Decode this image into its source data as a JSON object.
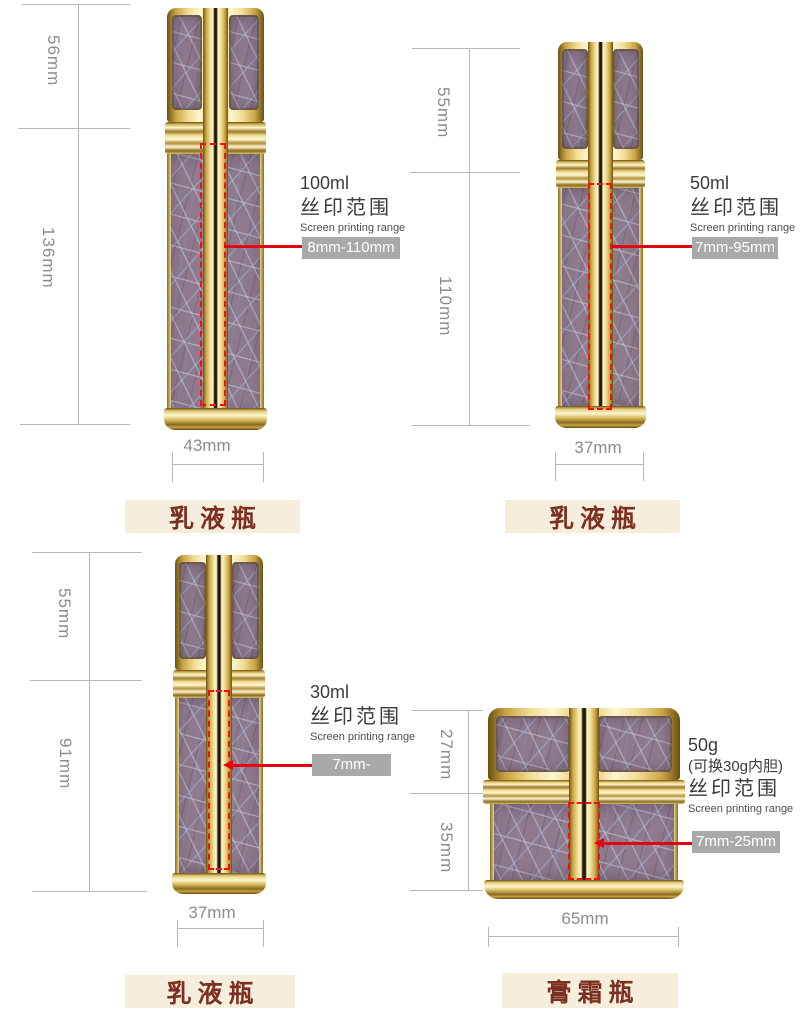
{
  "colors": {
    "accent_red": "#e60012",
    "badge_bg": "#a9a9a9",
    "badge_text": "#ffffff",
    "category_bg": "#f5eedd",
    "category_text": "#7c2f22",
    "dim_line": "#b7b7b7",
    "dim_text": "#8c8c8c",
    "gold_light": "#fdf6cf",
    "gold_mid": "#d4b254",
    "gold_dark": "#8a6a20",
    "texture_base": "#8d7a8c"
  },
  "products": [
    {
      "id": "lotion-bottle-100ml",
      "volume": "100ml",
      "print_range_cn": "丝印范围",
      "print_range_en": "Screen printing range",
      "print_range_value": "8mm-110mm",
      "dims": {
        "cap": "56mm",
        "body": "136mm",
        "width": "43mm"
      },
      "category": "乳液瓶"
    },
    {
      "id": "lotion-bottle-50ml",
      "volume": "50ml",
      "print_range_cn": "丝印范围",
      "print_range_en": "Screen printing range",
      "print_range_value": "7mm-95mm",
      "dims": {
        "cap": "55mm",
        "body": "110mm",
        "width": "37mm"
      },
      "category": "乳液瓶"
    },
    {
      "id": "lotion-bottle-30ml",
      "volume": "30ml",
      "print_range_cn": "丝印范围",
      "print_range_en": "Screen printing range",
      "print_range_value": "7mm-70mm",
      "dims": {
        "cap": "55mm",
        "body": "91mm",
        "width": "37mm"
      },
      "category": "乳液瓶"
    },
    {
      "id": "cream-jar-50g",
      "volume": "50g",
      "volume_note": "(可换30g内胆)",
      "print_range_cn": "丝印范围",
      "print_range_en": "Screen printing range",
      "print_range_value": "7mm-25mm",
      "dims": {
        "cap": "27mm",
        "body": "35mm",
        "width": "65mm"
      },
      "category": "膏霜瓶"
    }
  ]
}
